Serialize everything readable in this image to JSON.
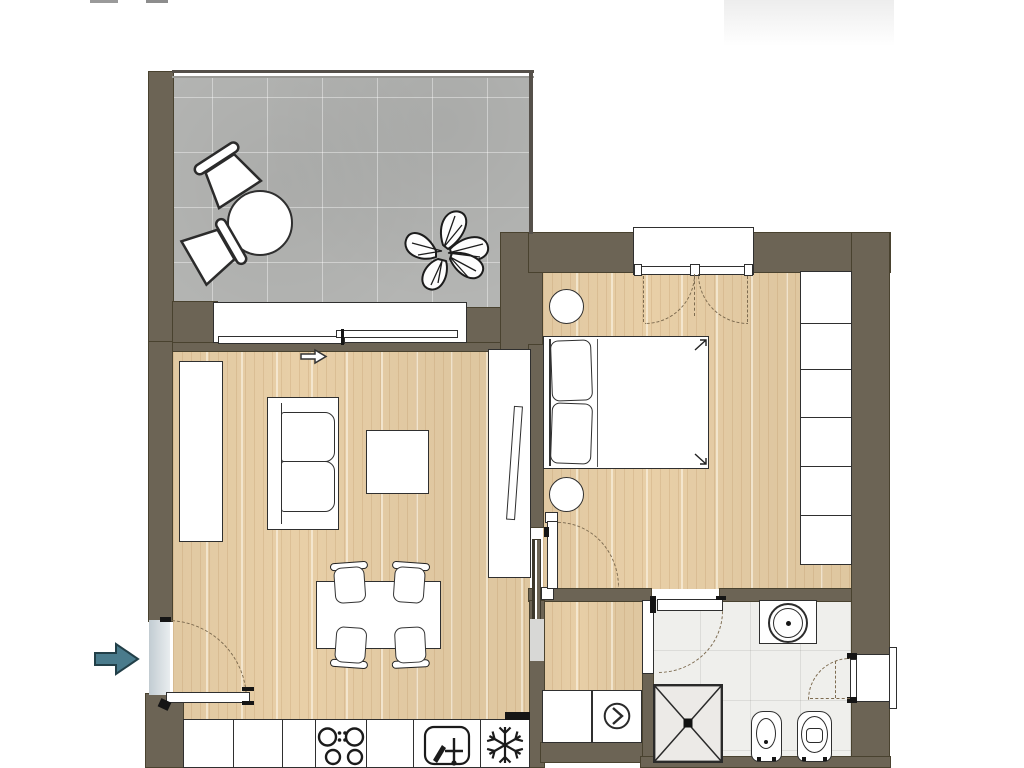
{
  "plan": {
    "type": "apartment-floor-plan",
    "colors": {
      "wall": "#6c6455",
      "wood_floor": "#e8cfa7",
      "balcony_tile": "#b4b5b3",
      "bath_tile": "#efefec",
      "outline": "#2f2f2f",
      "door_arc": "#7d6b50",
      "entrance_arrow": "#4a7b8c",
      "threshold": "#c9d3d8"
    },
    "rooms": [
      {
        "name": "balcony",
        "floor": "gray-ceramic-tile",
        "furniture": [
          "round-bistro-table",
          "chair",
          "chair",
          "monstera-plant"
        ]
      },
      {
        "name": "living-dining-room",
        "floor": "light-wood-parquet",
        "furniture": [
          "wall-cabinet",
          "two-seat-sofa",
          "coffee-table",
          "tv-sideboard",
          "tv",
          "radiator",
          "dining-table",
          "dining-chair-x4"
        ]
      },
      {
        "name": "kitchen",
        "floor": "light-wood-parquet",
        "furniture": [
          "base-cabinets",
          "cooktop-4-burners",
          "kitchen-sink",
          "freezer"
        ]
      },
      {
        "name": "bedroom",
        "floor": "light-wood-parquet",
        "furniture": [
          "double-bed",
          "pillow-x2",
          "round-nightstand-x2",
          "wardrobe-6-modules"
        ]
      },
      {
        "name": "bathroom",
        "floor": "white-ceramic-tile",
        "furniture": [
          "washbasin-counter",
          "shower",
          "bidet",
          "toilet"
        ]
      },
      {
        "name": "laundry-niche",
        "floor": "light-wood-parquet",
        "furniture": [
          "cabinet",
          "washing-machine"
        ]
      }
    ],
    "openings": [
      "entrance-door-with-swing-arc",
      "living-to-bedroom-door-with-swing-arc",
      "bathroom-door-with-swing-arc",
      "balcony-sliding-window",
      "bedroom-double-casement-window",
      "bathroom-casement-window"
    ],
    "icons": [
      "entrance-direction-arrow",
      "sliding-direction-arrow",
      "cooktop-burners-icon",
      "faucet-icon",
      "snowflake-freezer-icon",
      "washer-drum-icon"
    ]
  }
}
